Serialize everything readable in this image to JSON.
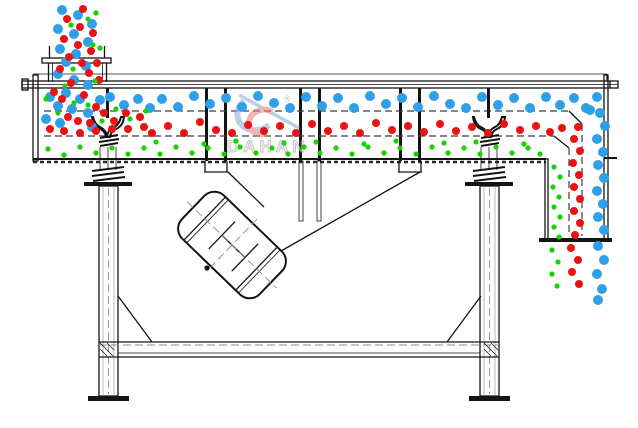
{
  "watermark": {
    "brand": "DAHAN",
    "reg": "®"
  },
  "colors": {
    "blue": "#2e9fe8",
    "red": "#ea1212",
    "green": "#16d303",
    "line": "#141414",
    "watermark_red": "#e2857c",
    "watermark_blue": "#93aed8",
    "watermark_text": "#9a9a9a"
  },
  "particles": {
    "blue": {
      "radius": 5,
      "points": [
        [
          62,
          10
        ],
        [
          78,
          15
        ],
        [
          92,
          24
        ],
        [
          58,
          29
        ],
        [
          74,
          34
        ],
        [
          88,
          42
        ],
        [
          60,
          49
        ],
        [
          76,
          54
        ],
        [
          66,
          62
        ],
        [
          86,
          66
        ],
        [
          58,
          74
        ],
        [
          74,
          80
        ],
        [
          88,
          85
        ],
        [
          50,
          97
        ],
        [
          66,
          93
        ],
        [
          80,
          99
        ],
        [
          58,
          106
        ],
        [
          72,
          109
        ],
        [
          88,
          113
        ],
        [
          100,
          100
        ],
        [
          46,
          119
        ],
        [
          92,
          127
        ],
        [
          60,
          123
        ],
        [
          110,
          97
        ],
        [
          124,
          105
        ],
        [
          138,
          99
        ],
        [
          150,
          108
        ],
        [
          162,
          99
        ],
        [
          178,
          107
        ],
        [
          194,
          96
        ],
        [
          210,
          104
        ],
        [
          226,
          98
        ],
        [
          242,
          107
        ],
        [
          258,
          96
        ],
        [
          274,
          103
        ],
        [
          290,
          108
        ],
        [
          306,
          97
        ],
        [
          322,
          106
        ],
        [
          338,
          98
        ],
        [
          354,
          108
        ],
        [
          370,
          96
        ],
        [
          386,
          104
        ],
        [
          402,
          98
        ],
        [
          418,
          107
        ],
        [
          434,
          96
        ],
        [
          450,
          104
        ],
        [
          466,
          108
        ],
        [
          482,
          97
        ],
        [
          498,
          105
        ],
        [
          514,
          98
        ],
        [
          530,
          108
        ],
        [
          546,
          97
        ],
        [
          560,
          105
        ],
        [
          574,
          98
        ],
        [
          586,
          108
        ],
        [
          597,
          97
        ],
        [
          590,
          110
        ],
        [
          600,
          113
        ],
        [
          605,
          126
        ],
        [
          597,
          139
        ],
        [
          603,
          152
        ],
        [
          598,
          165
        ],
        [
          604,
          178
        ],
        [
          597,
          191
        ],
        [
          603,
          204
        ],
        [
          598,
          217
        ],
        [
          604,
          230
        ],
        [
          598,
          246
        ],
        [
          604,
          260
        ],
        [
          597,
          274
        ],
        [
          602,
          289
        ],
        [
          598,
          300
        ]
      ]
    },
    "red": {
      "radius": 4,
      "points": [
        [
          83,
          9
        ],
        [
          67,
          19
        ],
        [
          80,
          27
        ],
        [
          93,
          33
        ],
        [
          64,
          39
        ],
        [
          78,
          45
        ],
        [
          91,
          51
        ],
        [
          69,
          57
        ],
        [
          82,
          63
        ],
        [
          60,
          69
        ],
        [
          89,
          73
        ],
        [
          71,
          83
        ],
        [
          97,
          63
        ],
        [
          99,
          80
        ],
        [
          54,
          92
        ],
        [
          62,
          99
        ],
        [
          84,
          95
        ],
        [
          96,
          107
        ],
        [
          68,
          117
        ],
        [
          78,
          121
        ],
        [
          90,
          123
        ],
        [
          104,
          113
        ],
        [
          114,
          121
        ],
        [
          126,
          113
        ],
        [
          140,
          117
        ],
        [
          50,
          129
        ],
        [
          64,
          131
        ],
        [
          80,
          133
        ],
        [
          96,
          131
        ],
        [
          112,
          129
        ],
        [
          128,
          129
        ],
        [
          144,
          127
        ],
        [
          152,
          133
        ],
        [
          168,
          126
        ],
        [
          184,
          133
        ],
        [
          200,
          122
        ],
        [
          216,
          130
        ],
        [
          232,
          133
        ],
        [
          248,
          125
        ],
        [
          264,
          131
        ],
        [
          280,
          126
        ],
        [
          296,
          133
        ],
        [
          312,
          124
        ],
        [
          328,
          131
        ],
        [
          344,
          126
        ],
        [
          360,
          133
        ],
        [
          376,
          123
        ],
        [
          392,
          130
        ],
        [
          408,
          126
        ],
        [
          424,
          132
        ],
        [
          440,
          124
        ],
        [
          456,
          131
        ],
        [
          472,
          127
        ],
        [
          488,
          133
        ],
        [
          504,
          124
        ],
        [
          520,
          130
        ],
        [
          536,
          126
        ],
        [
          550,
          132
        ],
        [
          562,
          128
        ],
        [
          578,
          127
        ],
        [
          574,
          139
        ],
        [
          580,
          151
        ],
        [
          573,
          163
        ],
        [
          579,
          175
        ],
        [
          574,
          187
        ],
        [
          580,
          199
        ],
        [
          574,
          211
        ],
        [
          580,
          223
        ],
        [
          575,
          235
        ],
        [
          571,
          248
        ],
        [
          578,
          260
        ],
        [
          572,
          272
        ],
        [
          579,
          284
        ]
      ]
    },
    "green": {
      "radius": 2.6,
      "points": [
        [
          96,
          13
        ],
        [
          88,
          19
        ],
        [
          71,
          25
        ],
        [
          93,
          45
        ],
        [
          73,
          69
        ],
        [
          95,
          81
        ],
        [
          100,
          48
        ],
        [
          65,
          86
        ],
        [
          46,
          99
        ],
        [
          58,
          113
        ],
        [
          74,
          103
        ],
        [
          88,
          105
        ],
        [
          102,
          121
        ],
        [
          116,
          109
        ],
        [
          130,
          119
        ],
        [
          146,
          111
        ],
        [
          48,
          149
        ],
        [
          64,
          155
        ],
        [
          80,
          147
        ],
        [
          96,
          153
        ],
        [
          112,
          148
        ],
        [
          128,
          154
        ],
        [
          144,
          148
        ],
        [
          160,
          154
        ],
        [
          176,
          147
        ],
        [
          192,
          153
        ],
        [
          208,
          148
        ],
        [
          224,
          154
        ],
        [
          240,
          147
        ],
        [
          256,
          153
        ],
        [
          272,
          148
        ],
        [
          288,
          154
        ],
        [
          304,
          147
        ],
        [
          320,
          153
        ],
        [
          336,
          148
        ],
        [
          352,
          154
        ],
        [
          368,
          147
        ],
        [
          384,
          153
        ],
        [
          400,
          148
        ],
        [
          416,
          154
        ],
        [
          432,
          147
        ],
        [
          448,
          153
        ],
        [
          464,
          148
        ],
        [
          480,
          154
        ],
        [
          496,
          147
        ],
        [
          512,
          153
        ],
        [
          528,
          148
        ],
        [
          540,
          154
        ],
        [
          156,
          142
        ],
        [
          236,
          141
        ],
        [
          316,
          142
        ],
        [
          396,
          141
        ],
        [
          476,
          142
        ],
        [
          204,
          144
        ],
        [
          284,
          143
        ],
        [
          364,
          144
        ],
        [
          444,
          143
        ],
        [
          524,
          144
        ],
        [
          554,
          167
        ],
        [
          560,
          177
        ],
        [
          553,
          187
        ],
        [
          559,
          197
        ],
        [
          554,
          207
        ],
        [
          560,
          217
        ],
        [
          554,
          227
        ],
        [
          559,
          237
        ],
        [
          552,
          250
        ],
        [
          558,
          262
        ],
        [
          552,
          274
        ],
        [
          557,
          286
        ]
      ]
    }
  }
}
